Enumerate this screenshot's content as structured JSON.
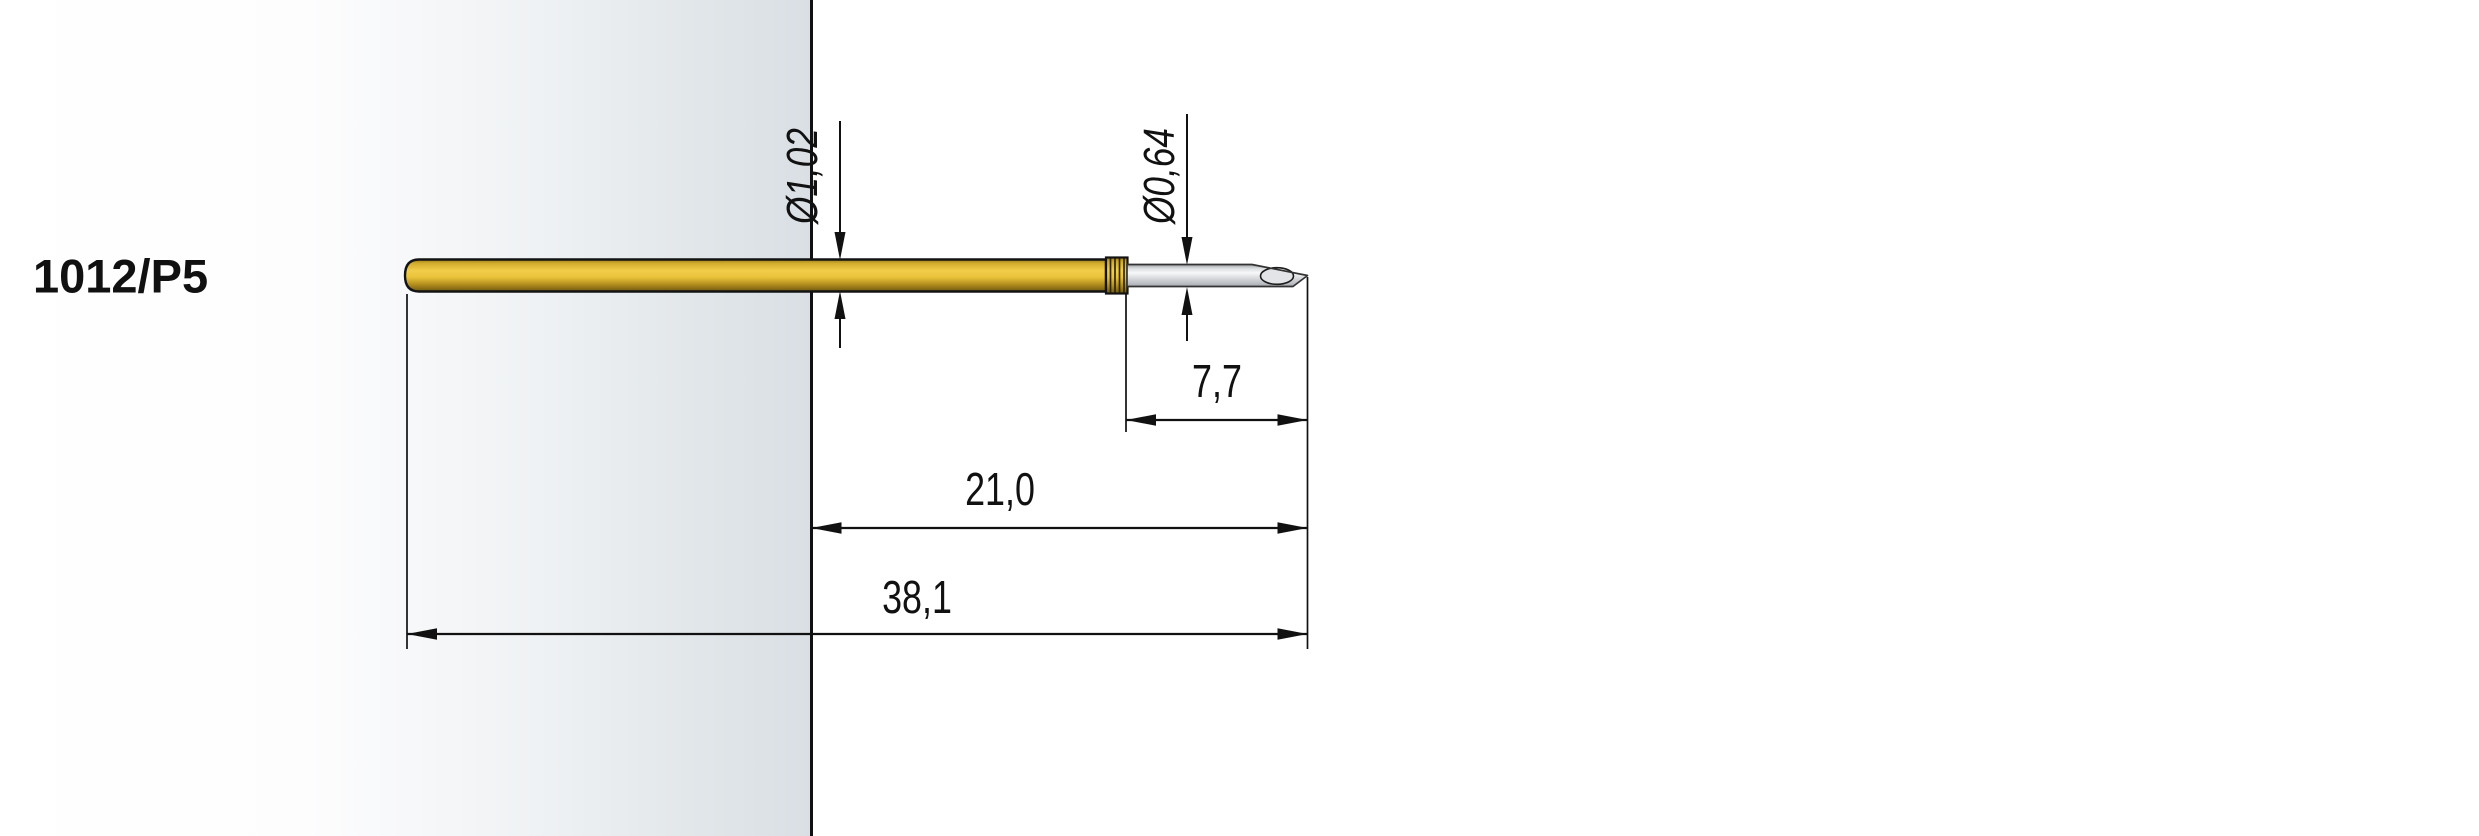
{
  "part_number": "1012/P5",
  "dimensions": {
    "shaft_diameter": "Ø1,02",
    "tip_diameter": "Ø0,64",
    "tip_length": "7,7",
    "exposed_length": "21,0",
    "overall_length": "38,1"
  },
  "colors": {
    "probe_gold": "#eec840",
    "needle_silver": "#d8dadd",
    "plate_gray": "#d9dfe4",
    "line_black": "#111111",
    "background": "#ffffff"
  }
}
